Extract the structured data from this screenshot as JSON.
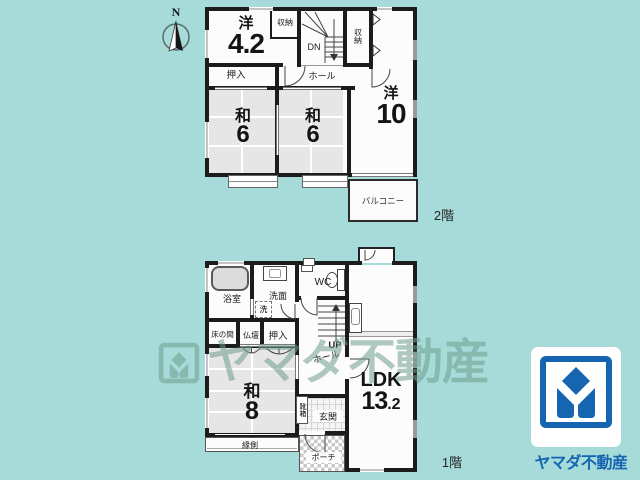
{
  "colors": {
    "background": "#a6dbd9",
    "wall": "#1c1c1c",
    "tatami": "#e6e6e6",
    "watermark_green": "#6f9e8d",
    "logo_blue": "#1565b0"
  },
  "compass": {
    "label": "N"
  },
  "floor2": {
    "label": "2階",
    "room_yo42": {
      "type": "洋",
      "size": "4.2"
    },
    "closet_a": "収納",
    "stair_dn": "DN",
    "closet_b": "収納",
    "oshiire": "押入",
    "hall": "ホール",
    "room_wa6_left": {
      "type": "和",
      "size": "6"
    },
    "room_wa6_right": {
      "type": "和",
      "size": "6"
    },
    "room_yo10": {
      "type": "洋",
      "size": "10"
    },
    "balcony": "バルコニー"
  },
  "floor1": {
    "label": "1階",
    "bath": "浴室",
    "washstand": "洗面",
    "laundry": "洗",
    "wc": "WC",
    "stair_up": "UP",
    "hall": "ホール",
    "tokonoma": "床の間",
    "butsudan": "仏壇",
    "oshiire": "押入",
    "room_wa8": {
      "type": "和",
      "size": "8"
    },
    "engawa": "縁側",
    "shoe_box": "靴箱",
    "entrance": "玄関",
    "porch": "ポーチ",
    "ldk": {
      "type": "LDK",
      "size_int": "13",
      "size_dec": ".2"
    }
  },
  "watermark": {
    "text": "ヤマダ不動産"
  },
  "logo": {
    "company": "ヤマダ不動産"
  }
}
